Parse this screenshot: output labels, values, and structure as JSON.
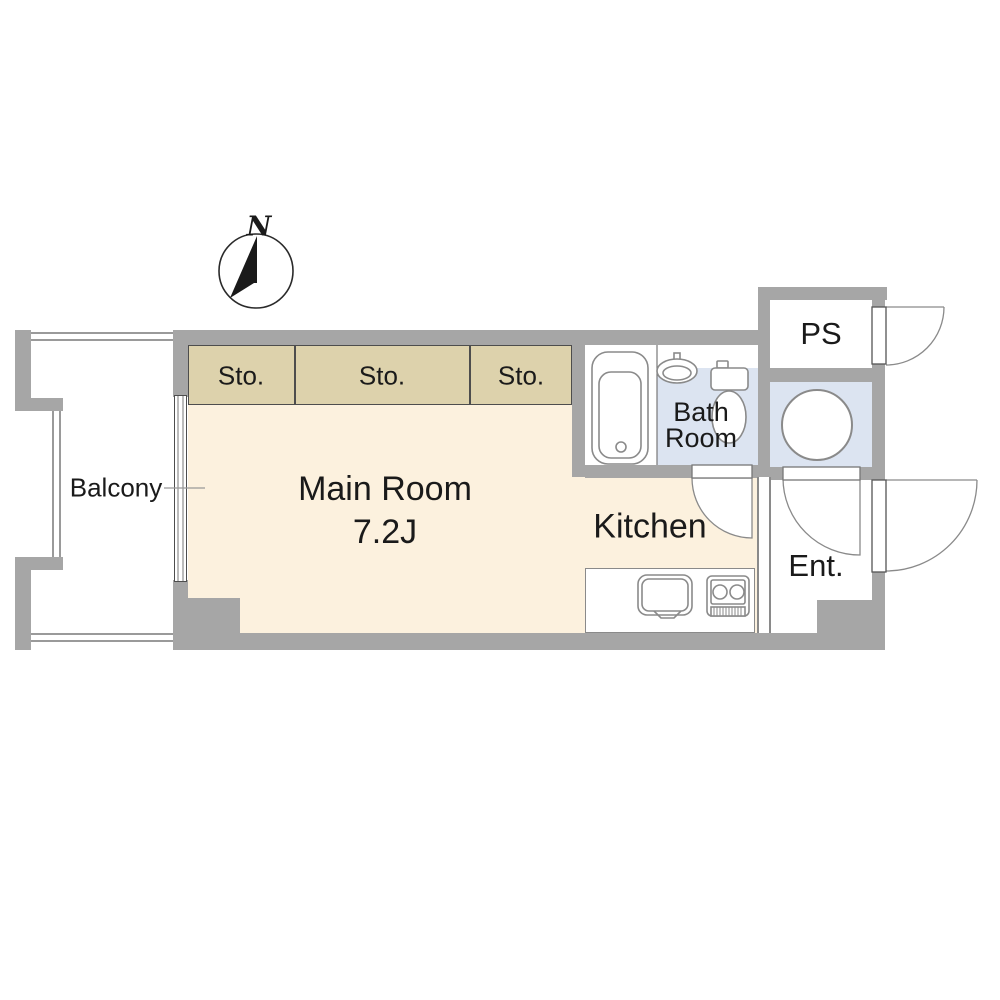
{
  "floor_plan": {
    "compass": {
      "north_label": "N"
    },
    "rooms": {
      "balcony": {
        "label": "Balcony"
      },
      "main_room": {
        "label": "Main Room",
        "size": "7.2J"
      },
      "storage_1": {
        "label": "Sto."
      },
      "storage_2": {
        "label": "Sto."
      },
      "storage_3": {
        "label": "Sto."
      },
      "kitchen": {
        "label": "Kitchen"
      },
      "bath_room": {
        "label_line1": "Bath",
        "label_line2": "Room"
      },
      "pipe_space": {
        "label": "PS"
      },
      "entrance": {
        "label": "Ent."
      }
    },
    "fixtures": [
      "bathtub",
      "wash-basin",
      "toilet",
      "washing-machine-pan",
      "kitchen-sink",
      "gas-stove",
      "sliding-window",
      "door-swing-arcs",
      "compass-north-arrow"
    ],
    "colors": {
      "wall_gray": "#a6a6a6",
      "room_cream": "#fcf1de",
      "storage_tan": "#ddd2ac",
      "bath_blue": "#dce4f1",
      "outline_dark": "#4d4d4d",
      "fixture_gray": "#8a8a8a",
      "rail_gray": "#9a9a9a",
      "text": "#1a1a1a"
    }
  }
}
